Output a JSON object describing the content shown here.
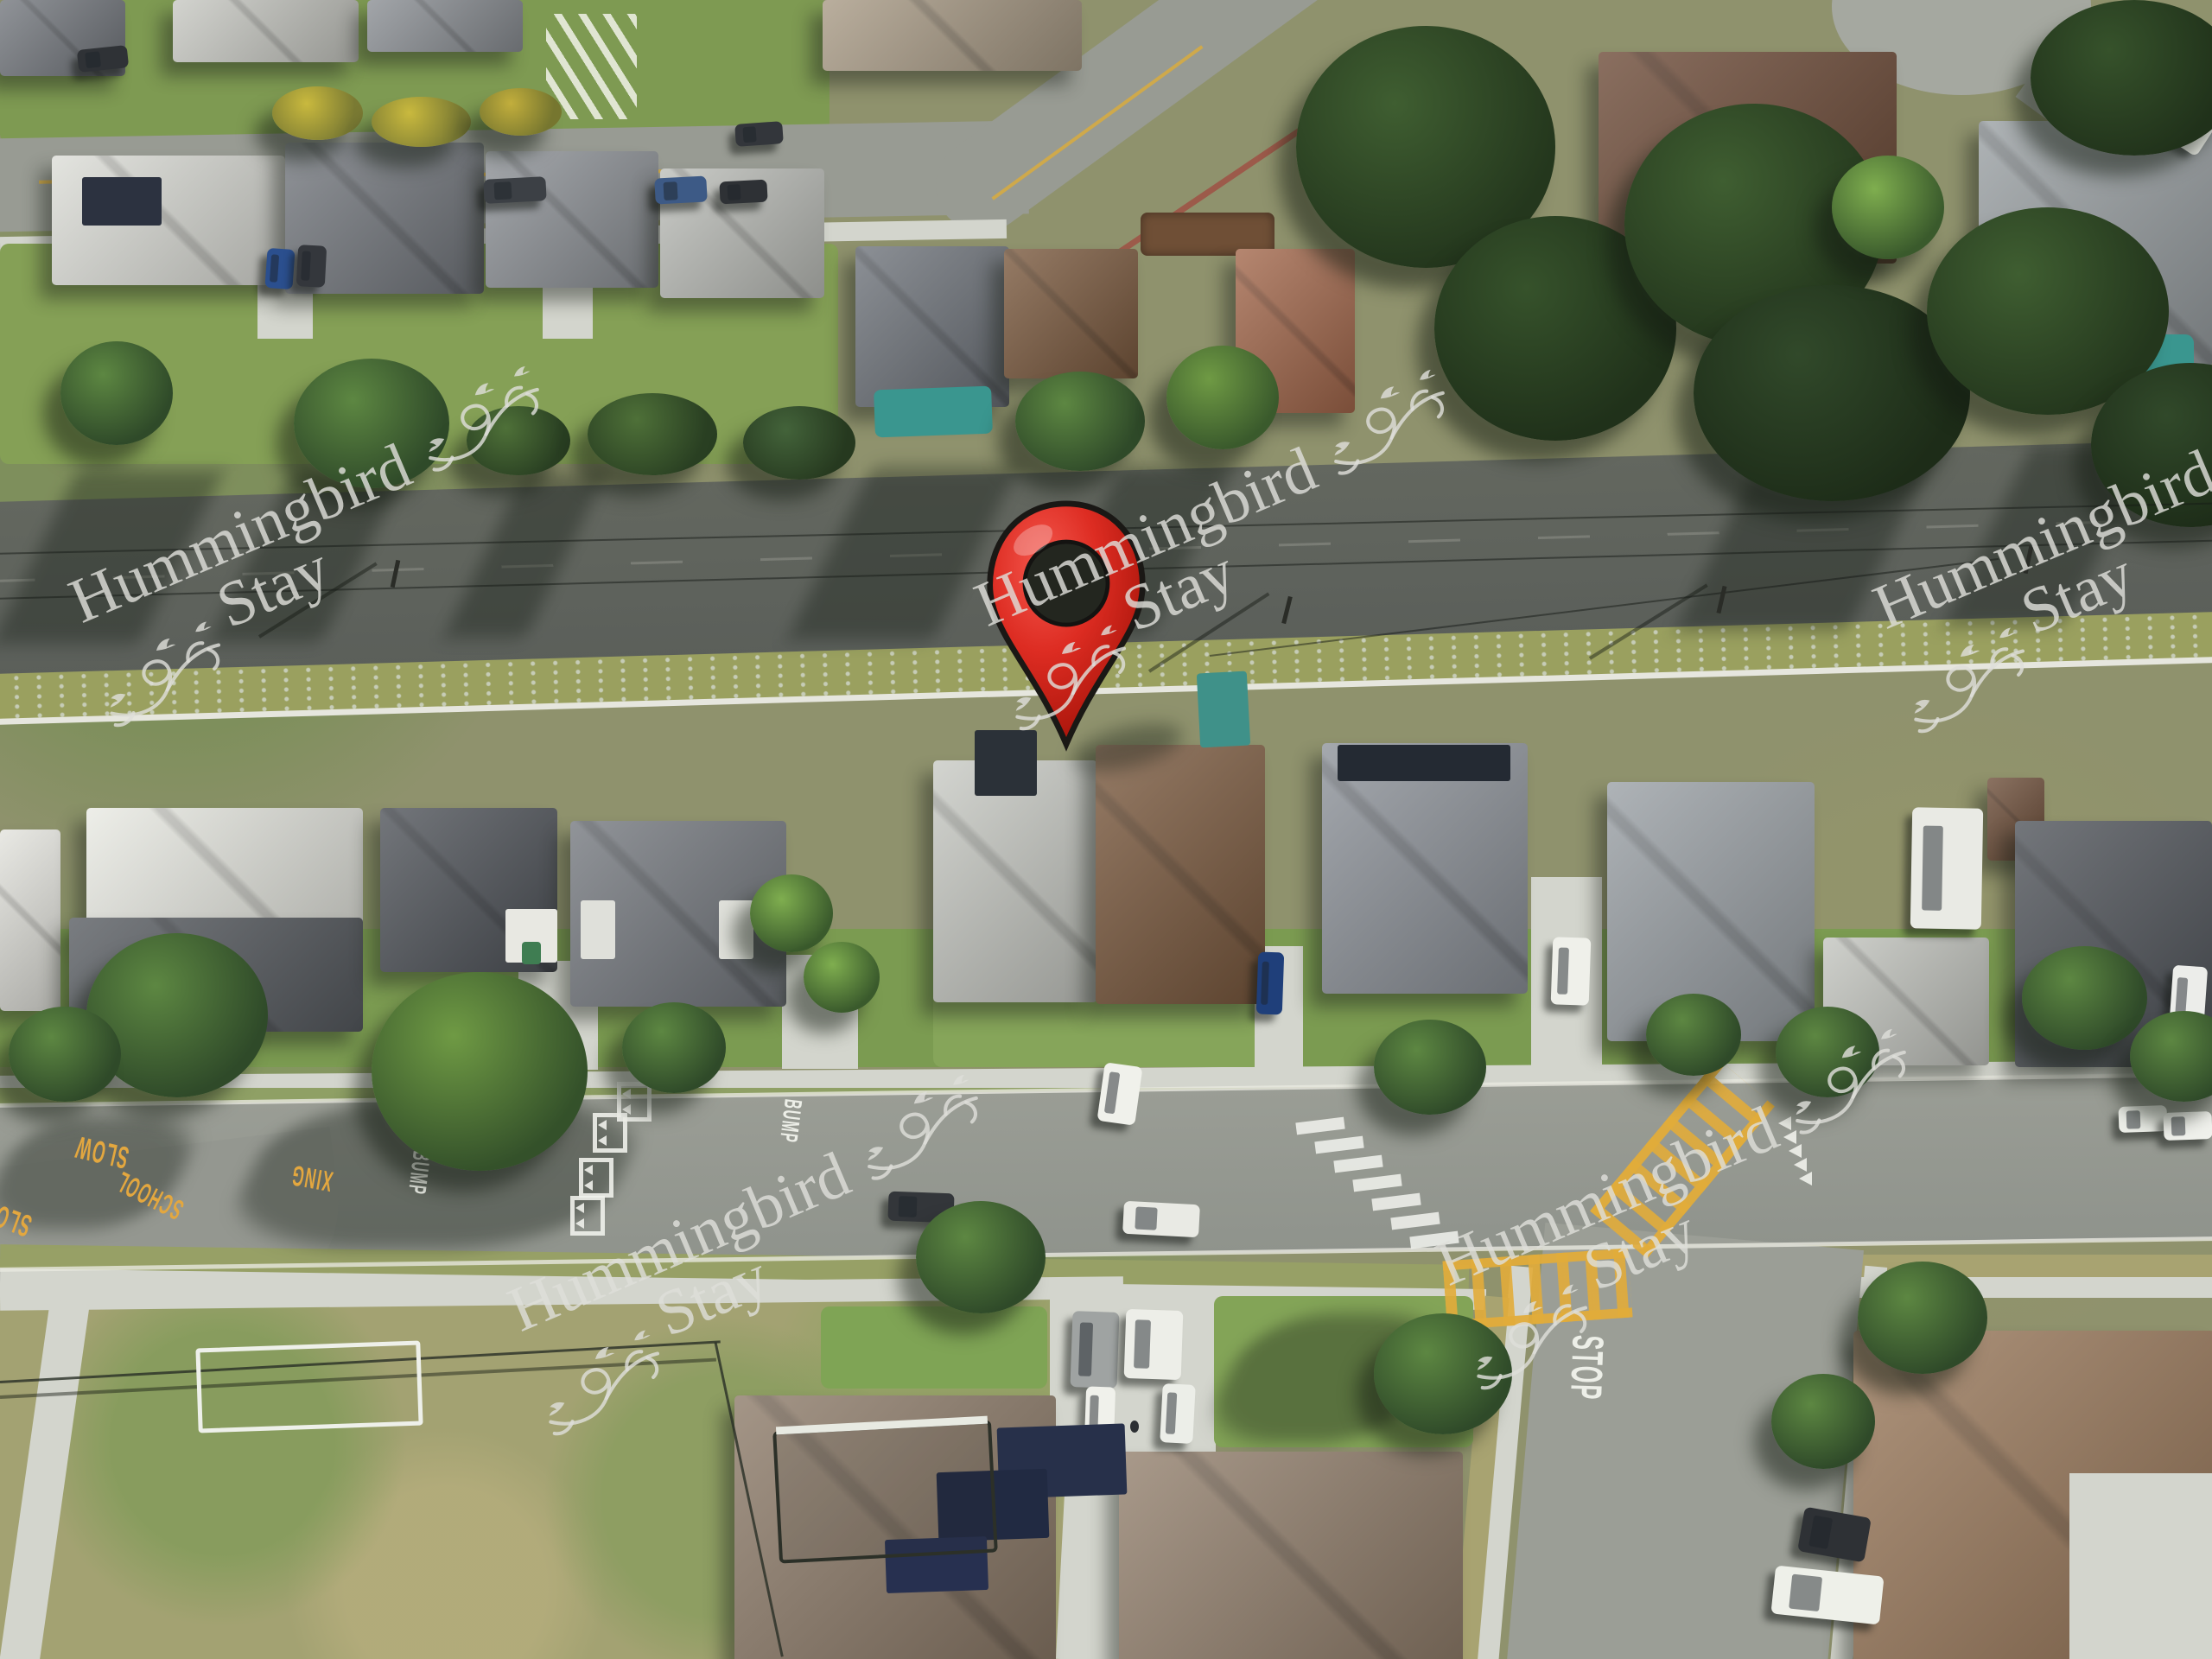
{
  "watermark": {
    "line1": "Hummingbird",
    "line2": "Stay",
    "instances": 5
  },
  "road_markings": {
    "slow": "SLOW",
    "school": "SCHOOL",
    "xing": "XING",
    "bump": "BUMP",
    "stop": "STOP"
  },
  "map_pin": {
    "icon": "location-pin"
  },
  "colors": {
    "asphalt_dark": "#5b5f5a",
    "asphalt_light": "#989b93",
    "concrete": "#d3d5cd",
    "grass_green": "#7d9c52",
    "grass_dry": "#a8a371",
    "roof_gray": "#74787e",
    "roof_dark": "#50545a",
    "roof_brown": "#7b5a3f",
    "roof_taupe": "#8d7b69",
    "roof_white": "#e9eae3",
    "pool_teal": "#3a968f",
    "marking_yellow": "#e3a73f",
    "marking_white": "#edefe8",
    "watermark": "rgba(222,222,217,0.82)",
    "pin_red": "#dd2c22",
    "pin_red_dark": "#a31208",
    "pin_outline": "#1a1815"
  }
}
